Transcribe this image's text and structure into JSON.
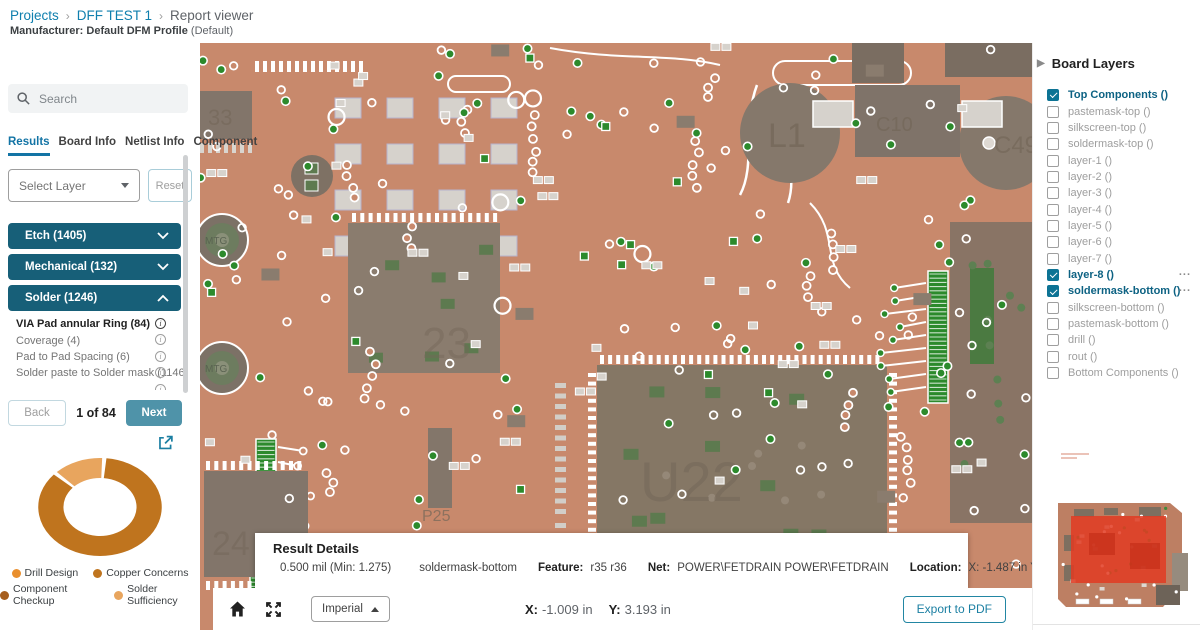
{
  "header": {
    "breadcrumb": [
      {
        "label": "Projects"
      },
      {
        "label": "DFF TEST 1"
      },
      {
        "label": "Report viewer"
      }
    ],
    "manufacturer_label": "Manufacturer:",
    "manufacturer_value": "Default DFM Profile",
    "manufacturer_suffix": "(Default)"
  },
  "sidebar": {
    "search_placeholder": "Search",
    "tabs": [
      "Results",
      "Board Info",
      "Netlist Info",
      "Component"
    ],
    "active_tab": "Results",
    "layer_select": {
      "value": "Select Layer"
    },
    "reset_label": "Reset",
    "sections": [
      {
        "label": "Etch (1405)",
        "expanded": false
      },
      {
        "label": "Mechanical (132)",
        "expanded": false
      },
      {
        "label": "Solder (1246)",
        "expanded": true
      }
    ],
    "results": [
      {
        "label": "VIA Pad annular Ring (84)",
        "active": true
      },
      {
        "label": "Coverage (4)",
        "active": false
      },
      {
        "label": "Pad to Pad Spacing (6)",
        "active": false
      },
      {
        "label": "Solder paste to Solder mask (1146)",
        "active": false
      }
    ],
    "pager": {
      "back": "Back",
      "position": "1 of 84",
      "next": "Next"
    }
  },
  "chart_data": {
    "type": "pie",
    "donut": true,
    "inner_radius_ratio": 0.6,
    "title": "",
    "segments": [
      {
        "name": "Copper Concerns",
        "value": 86,
        "color": "#bf741e"
      },
      {
        "name": "Solder Sufficiency",
        "value": 14,
        "color": "#e8a55e"
      }
    ],
    "legend": [
      {
        "label": "Drill Design",
        "color": "#e98f2e"
      },
      {
        "label": "Copper Concerns",
        "color": "#bf741e"
      },
      {
        "label": "Component Checkup",
        "color": "#a65e1e"
      },
      {
        "label": "Solder Sufficiency",
        "color": "#e8a55e"
      }
    ],
    "legend_position": "bottom"
  },
  "board_layers": {
    "title": "Board Layers",
    "more_indicator": "...",
    "layers": [
      {
        "label": "Top Components ()",
        "checked": true,
        "more": false
      },
      {
        "label": "pastemask-top ()",
        "checked": false,
        "more": false
      },
      {
        "label": "silkscreen-top ()",
        "checked": false,
        "more": false
      },
      {
        "label": "soldermask-top ()",
        "checked": false,
        "more": false
      },
      {
        "label": "layer-1 ()",
        "checked": false,
        "more": false
      },
      {
        "label": "layer-2 ()",
        "checked": false,
        "more": false
      },
      {
        "label": "layer-3 ()",
        "checked": false,
        "more": false
      },
      {
        "label": "layer-4 ()",
        "checked": false,
        "more": false
      },
      {
        "label": "layer-5 ()",
        "checked": false,
        "more": false
      },
      {
        "label": "layer-6 ()",
        "checked": false,
        "more": false
      },
      {
        "label": "layer-7 ()",
        "checked": false,
        "more": false
      },
      {
        "label": "layer-8 ()",
        "checked": true,
        "more": true
      },
      {
        "label": "soldermask-bottom ()",
        "checked": true,
        "more": true
      },
      {
        "label": "silkscreen-bottom ()",
        "checked": false,
        "more": false
      },
      {
        "label": "pastemask-bottom ()",
        "checked": false,
        "more": false
      },
      {
        "label": "drill ()",
        "checked": false,
        "more": false
      },
      {
        "label": "rout ()",
        "checked": false,
        "more": false
      },
      {
        "label": "Bottom Components ()",
        "checked": false,
        "more": false
      }
    ]
  },
  "result_details": {
    "title": "Result Details",
    "measurement": "0.500 mil (Min: 1.275)",
    "layer": "soldermask-bottom",
    "feature_label": "Feature:",
    "feature": "r35 r36",
    "net_label": "Net:",
    "net": "POWER\\FETDRAIN POWER\\FETDRAIN",
    "location_label": "Location:",
    "location": "X: -1.487 in Y: 3.8 in"
  },
  "toolbar": {
    "units": "Imperial",
    "x_label": "X:",
    "x_value": "-1.009 in",
    "y_label": "Y:",
    "y_value": "3.193 in",
    "export_label": "Export to PDF"
  },
  "board": {
    "labels": {
      "l1": "L1",
      "u22": "U22",
      "mtg": "MTG",
      "c10": "C10",
      "c49": "C49",
      "chip23": "23",
      "chip24": "24",
      "chip33": "33",
      "p25": "P25"
    }
  }
}
